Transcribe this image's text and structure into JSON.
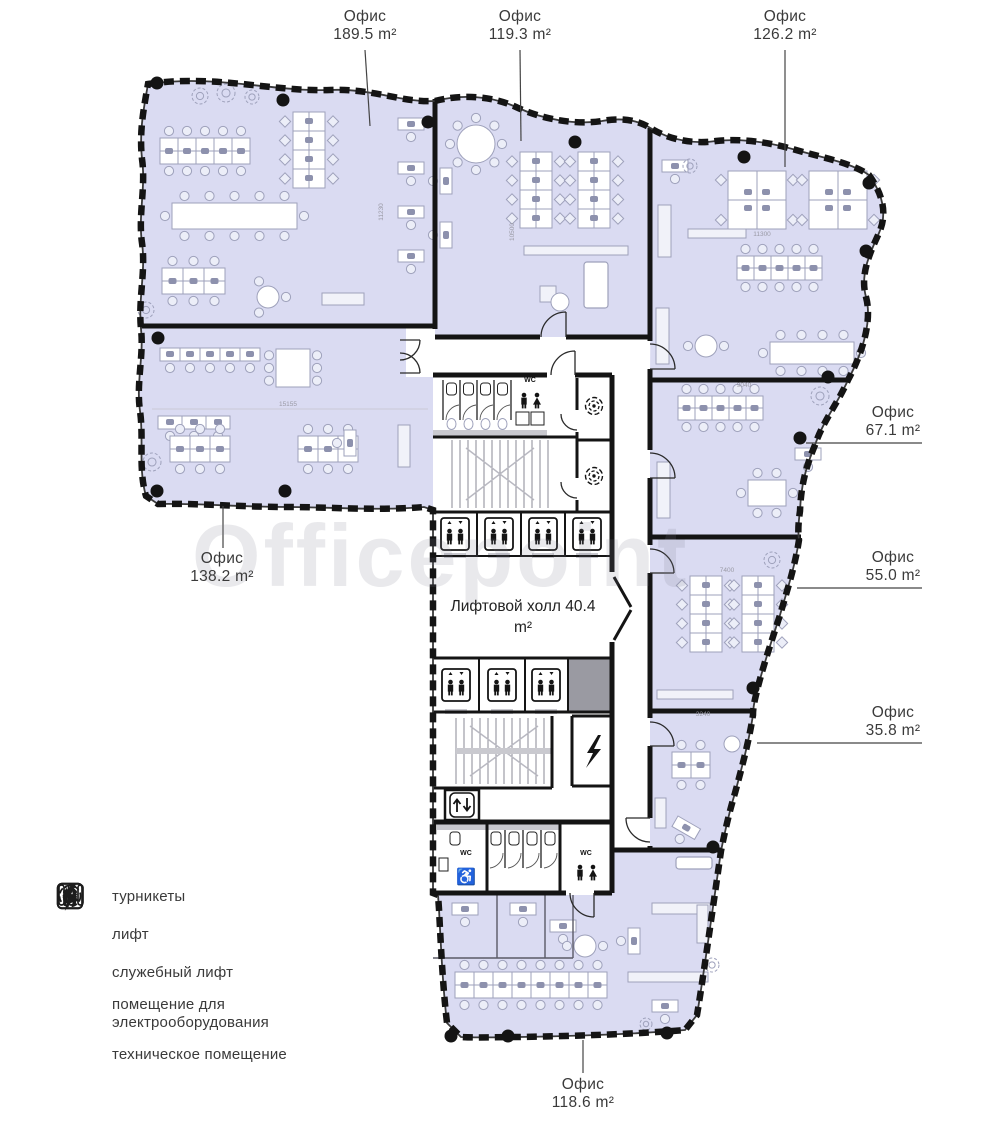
{
  "watermark": "Officepoint",
  "colors": {
    "office_fill": "#dadbf2",
    "wall": "#141414",
    "furniture": "#9ea1bb",
    "furniture_fill": "#ffffff",
    "chair_fill": "#eceef8",
    "blob": "#8d91ad",
    "gray_room": "#9a9aa2",
    "counter_gray": "#c9c9cf",
    "stair_line": "#8a8a94",
    "leader": "#444444",
    "dim_text": "#9a9aa5",
    "icon_black": "#141414"
  },
  "callouts": [
    {
      "label": "Офис",
      "area": "189.5 m²"
    },
    {
      "label": "Офис",
      "area": "119.3 m²"
    },
    {
      "label": "Офис",
      "area": "126.2 m²"
    },
    {
      "label": "Офис",
      "area": "67.1 m²"
    },
    {
      "label": "Офис",
      "area": "55.0 m²"
    },
    {
      "label": "Офис",
      "area": "35.8 m²"
    },
    {
      "label": "Офис",
      "area": "138.2 m²"
    },
    {
      "label": "Офис",
      "area": "118.6 m²"
    }
  ],
  "hall": {
    "label": "Лифтовой холл",
    "area": "40.4 m²"
  },
  "legend": {
    "items": [
      {
        "icon": "turnstiles-icon",
        "label": "турникеты"
      },
      {
        "icon": "elevator-icon",
        "label": "лифт"
      },
      {
        "icon": "service-elevator-icon",
        "label": "служебный лифт"
      },
      {
        "icon": "electrical-room-icon",
        "label": "помещение для электрооборудования"
      },
      {
        "icon": "technical-room-icon",
        "label": "техническое помещение"
      }
    ]
  },
  "plan": {
    "wc_label": "WC",
    "dimensions": [
      {
        "text": "11230",
        "x": 383,
        "y": 212,
        "rot": -90
      },
      {
        "text": "10500",
        "x": 514,
        "y": 232,
        "rot": -90
      },
      {
        "text": "15155",
        "x": 288,
        "y": 406,
        "rot": 0
      },
      {
        "text": "11300",
        "x": 762,
        "y": 236,
        "rot": 0
      },
      {
        "text": "9040",
        "x": 744,
        "y": 387,
        "rot": 0
      },
      {
        "text": "7400",
        "x": 727,
        "y": 572,
        "rot": 0
      },
      {
        "text": "3240",
        "x": 703,
        "y": 716,
        "rot": 0
      }
    ]
  }
}
